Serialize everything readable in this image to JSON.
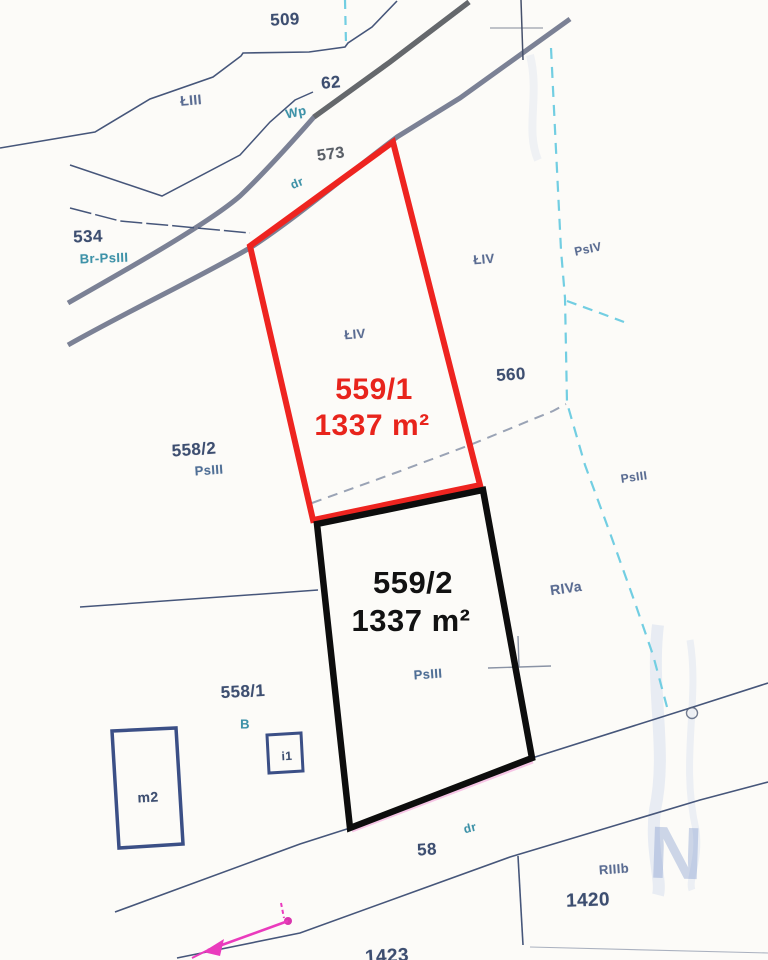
{
  "map": {
    "type": "cadastral-parcel-map",
    "colors": {
      "background": "#fcfbf8",
      "parcel_559_1_outline": "#ee2420",
      "parcel_559_2_outline": "#0d0d0d",
      "boundary_thin": "#46567a",
      "road_edge": "#7b8195",
      "road_edge_dark": "#65686c",
      "soil_class_dashed": "#72cee2",
      "proposed_split_dashed": "#9aa3b5",
      "building_outline": "#3b4f86",
      "label_navy": "#3d4e70",
      "label_teal": "#3e92a8",
      "label_soil": "#5a6c92",
      "annotation_red": "#e8241c",
      "annotation_black": "#121212",
      "arrow_pink": "#ea3bbd",
      "watermark_blue": "#6e8cc8"
    },
    "labels": {
      "l509": "509",
      "l62": "62",
      "lwp": "Wp",
      "l573": "573",
      "ldr_top": "dr",
      "lliii": "ŁIII",
      "l534": "534",
      "lbrpsiii": "Br-PsIII",
      "lliv_in": "ŁIV",
      "lliv_right": "ŁIV",
      "lpsiv": "PsIV",
      "l560": "560",
      "l5582": "558/2",
      "lpsiii_5582": "PsIII",
      "l5591": "559/1",
      "l5591_area": "1337 m²",
      "l5592": "559/2",
      "l5592_area": "1337 m²",
      "lpsiii_5592": "PsIII",
      "lriva": "RIVa",
      "lpsiii_right": "PsIII",
      "l5581": "558/1",
      "lb": "B",
      "li1": "i1",
      "lm2": "m2",
      "ldr_bottom": "dr",
      "l58": "58",
      "lriiib": "RIIIb",
      "l1420": "1420",
      "l1423": "1423",
      "lwatermark": "N"
    }
  }
}
